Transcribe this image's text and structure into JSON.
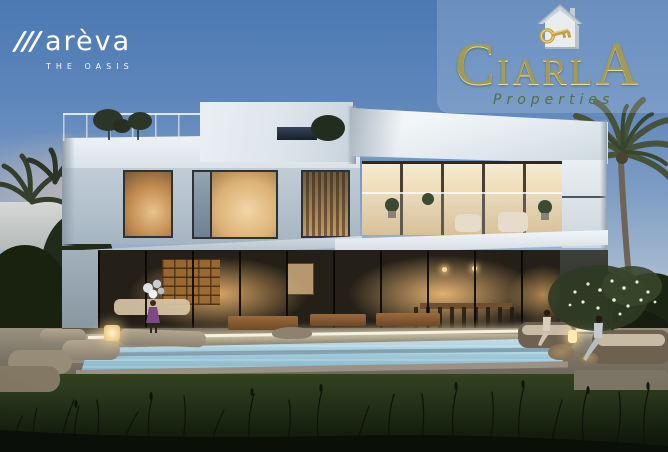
{
  "branding": {
    "mareva": {
      "wordmark": "marèva",
      "wordmark_rest": "arèva",
      "tagline": "THE OASIS",
      "color": "#ffffff"
    },
    "ciarla": {
      "wordmark": "CIARLA",
      "letter_first": "C",
      "letters_middle": "IARL",
      "letter_last": "A",
      "tagline": "Properties",
      "gold": "#a39a54",
      "green": "#55703f",
      "icon": "house-with-key-icon"
    }
  },
  "scene": {
    "type": "architectural-rendering",
    "subject": "modern two-storey white villa with pool, lawn and palm trees at dusk",
    "colors": {
      "sky_top": "#4c79b3",
      "sky_horizon": "#d8cec6",
      "villa_white": "#eff3f6",
      "villa_shadow": "#a5b4c1",
      "window_glow": "#e3bd82",
      "window_frame": "#2d3234",
      "pool_water": "#9cc6d8",
      "pool_led": "#f5f1e3",
      "deck": "#837c6d",
      "grass": "#25331a",
      "foliage": "#45523a",
      "child_dress": "#7c4a80"
    }
  }
}
